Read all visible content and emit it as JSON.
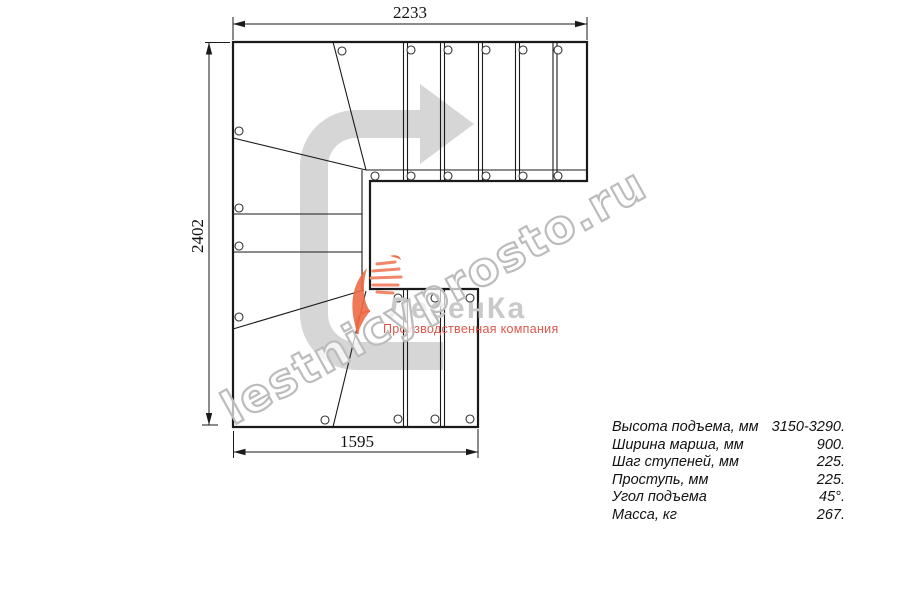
{
  "drawing": {
    "dim_top": "2233",
    "dim_left": "2402",
    "dim_bottom": "1595"
  },
  "specs": {
    "rows": [
      {
        "label": "Высота подъема, мм",
        "value": "3150-3290."
      },
      {
        "label": "Ширина марша, мм",
        "value": "900."
      },
      {
        "label": "Шаг ступеней, мм",
        "value": "225."
      },
      {
        "label": "Проступь, мм",
        "value": "225."
      },
      {
        "label": "Угол подъема",
        "value": "45°."
      },
      {
        "label": "Масса, кг",
        "value": "267."
      }
    ]
  },
  "logo": {
    "brand": "ЛесенКа",
    "tagline": "Производственная компания"
  },
  "watermark": {
    "text": "lestnicyprosto.ru"
  },
  "colors": {
    "line": "#1a1a1a",
    "direction_arrow": "#d6d6d6",
    "watermark_outline": "#bcbcbc",
    "brand_gray": "#c9c9c9",
    "accent_orange": "#ee6a45",
    "tagline_red": "#e0564a"
  },
  "icons": {
    "direction_arrow": "u-turn-travel-arrow",
    "logo_mark": "orange-stair-leaf-swoosh"
  }
}
